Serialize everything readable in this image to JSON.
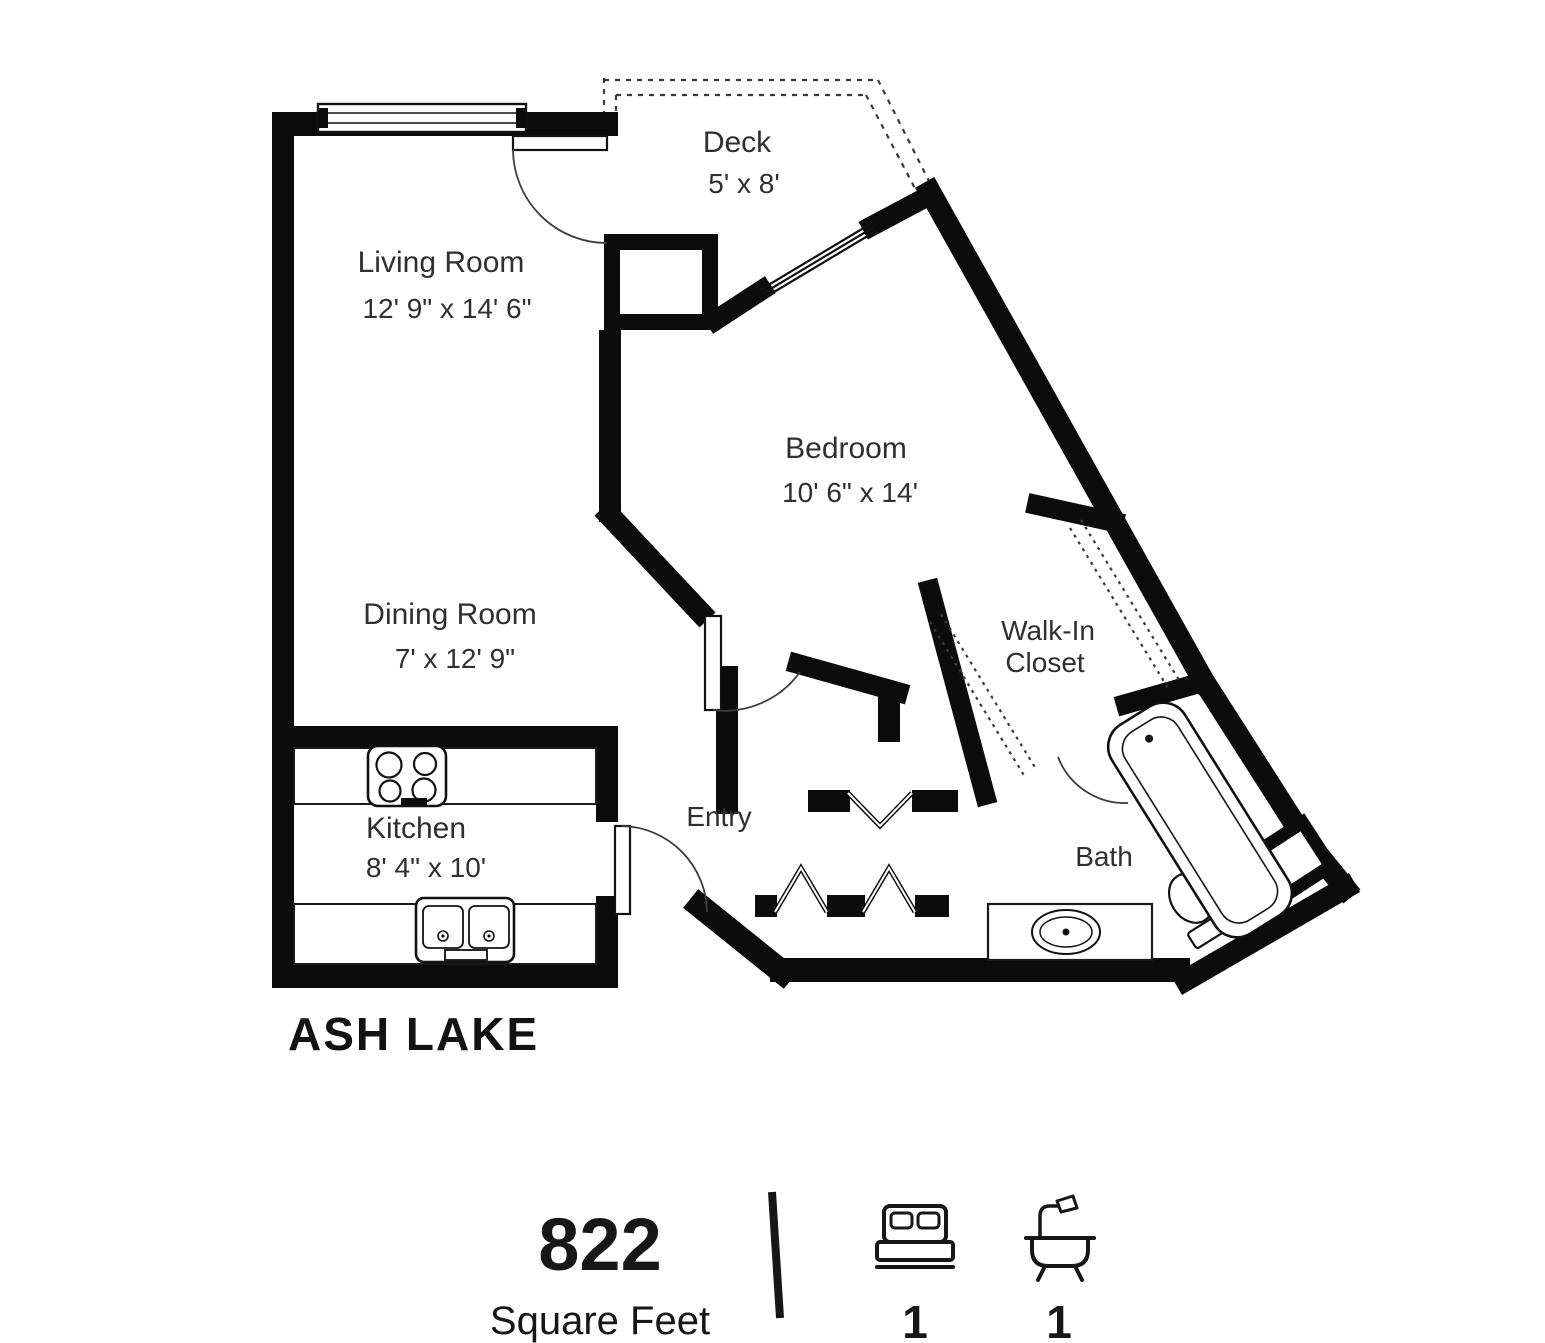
{
  "plan": {
    "title": "ASH LAKE",
    "rooms": {
      "living": {
        "label": "Living Room",
        "dims": "12' 9\" x 14' 6\""
      },
      "dining": {
        "label": "Dining Room",
        "dims": "7' x 12' 9\""
      },
      "kitchen": {
        "label": "Kitchen",
        "dims": "8' 4\" x 10'"
      },
      "deck": {
        "label": "Deck",
        "dims": "5' x 8'"
      },
      "bedroom": {
        "label": "Bedroom",
        "dims": "10' 6\" x 14'"
      },
      "walk_in_closet": {
        "label_line1": "Walk-In",
        "label_line2": "Closet"
      },
      "entry": {
        "label": "Entry"
      },
      "bath": {
        "label": "Bath"
      }
    }
  },
  "footer": {
    "area_value": "822",
    "area_label": "Square Feet",
    "bedrooms": {
      "icon": "bed-icon",
      "count": "1"
    },
    "bathrooms": {
      "icon": "bathtub-icon",
      "count": "1"
    }
  },
  "colors": {
    "wall": "#0c0c0c",
    "label": "#2f2f2f",
    "ink": "#171717",
    "background": "#ffffff"
  }
}
